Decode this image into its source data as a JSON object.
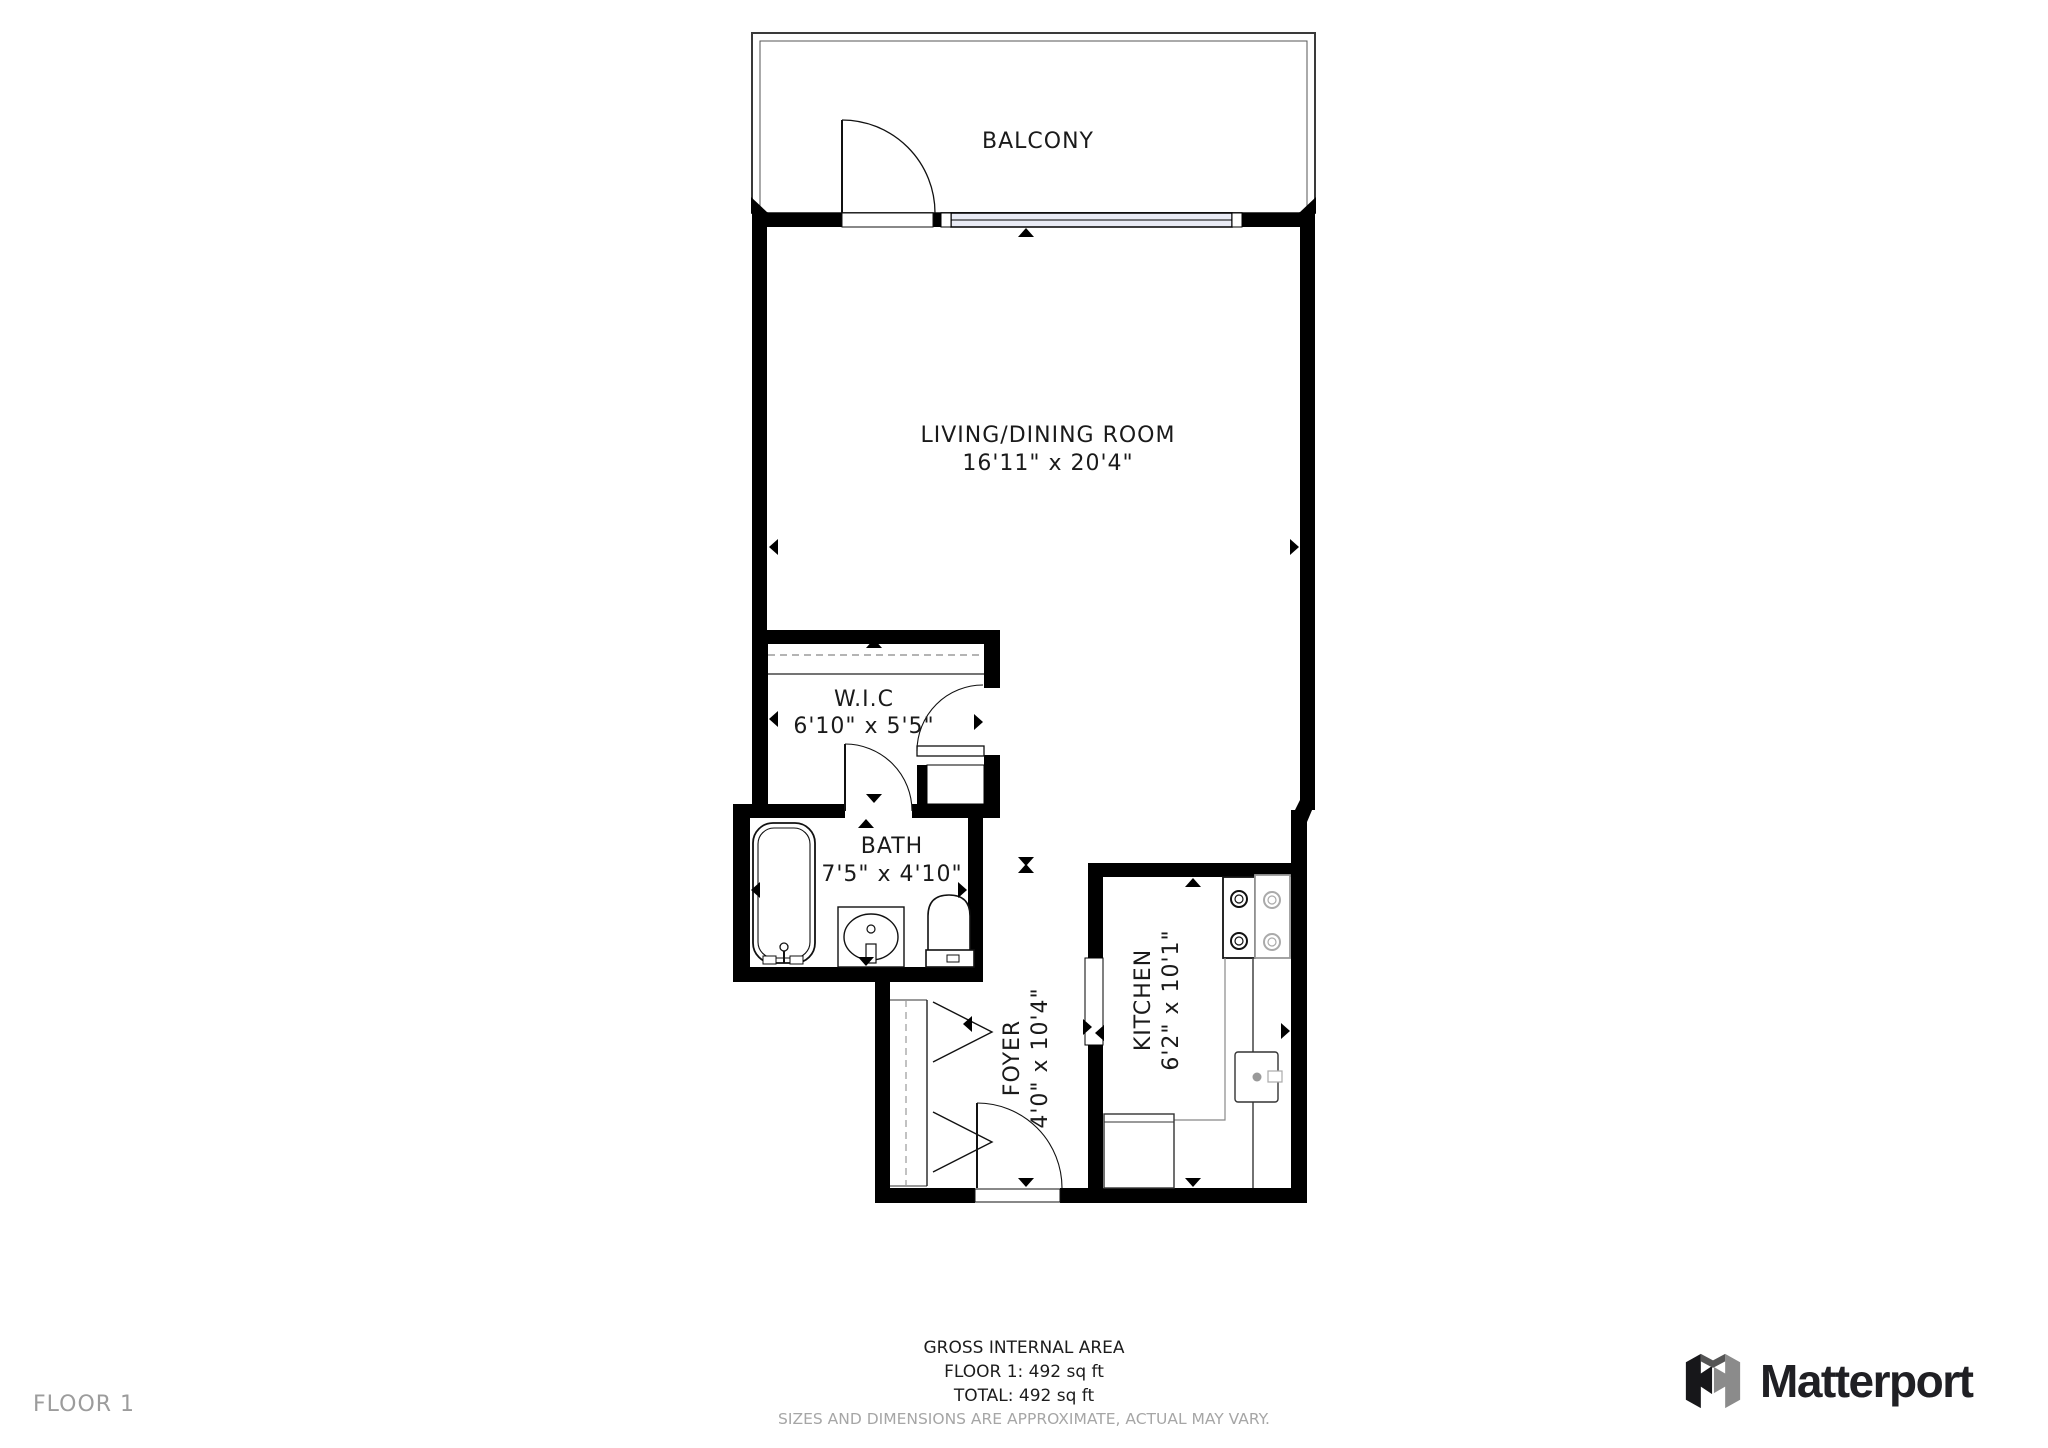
{
  "plan": {
    "rooms": {
      "balcony": {
        "name": "BALCONY"
      },
      "living": {
        "name": "LIVING/DINING ROOM",
        "dims": "16'11\" x 20'4\""
      },
      "wic": {
        "name": "W.I.C",
        "dims": "6'10\" x 5'5\""
      },
      "bath": {
        "name": "BATH",
        "dims": "7'5\" x 4'10\""
      },
      "foyer": {
        "name": "FOYER",
        "dims": "4'0\" x 10'4\""
      },
      "kitchen": {
        "name": "KITCHEN",
        "dims": "6'2\" x 10'1\""
      }
    },
    "colors": {
      "wall": "#000000",
      "window_fill": "#e9ebf5",
      "label_text": "#1a1a1a",
      "muted_text": "#a6a6a6",
      "floor_label_text": "#9c9c9c",
      "brand_text": "#202024",
      "brand_mark_gray": "#8b8b8b"
    }
  },
  "footer": {
    "area_title": "GROSS INTERNAL AREA",
    "floor_area": "FLOOR 1: 492 sq ft",
    "total_area": "TOTAL: 492 sq ft",
    "disclaimer": "SIZES AND DIMENSIONS ARE APPROXIMATE, ACTUAL MAY VARY.",
    "floor_label": "FLOOR 1",
    "brand": "Matterport"
  }
}
